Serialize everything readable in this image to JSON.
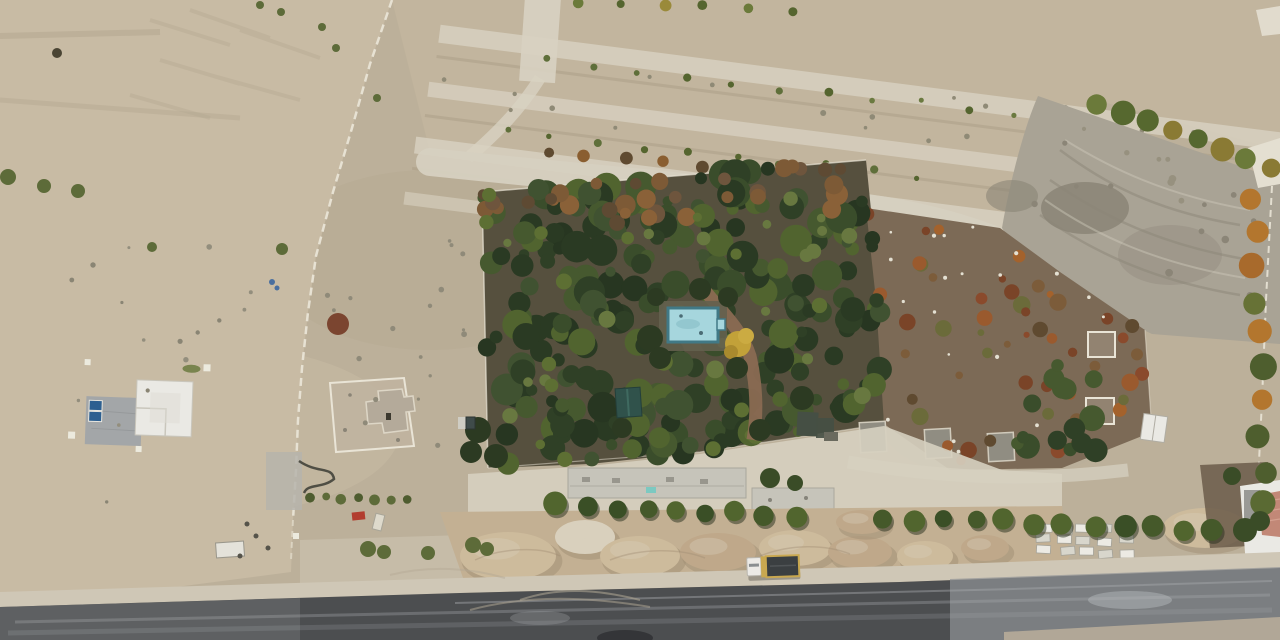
{
  "scene": {
    "kind": "aerial-drone-photograph",
    "subject": "arid construction site with walled orchard, swimming pool, terraced planting strips, sand piles, asphalt road and dump truck"
  },
  "palette": {
    "soil_base": "#bcb09a",
    "soil_left": "#c8bba4",
    "soil_strip": "#c2b59e",
    "ridge_pale": "#d8d2c2",
    "furrow": "#a89b83",
    "path_pale": "#d6d0c0",
    "excav": "#a9a395",
    "excav_dark": "#8b8577",
    "scar_light": "#cfc9ba",
    "white_path": "#e4dfd1",
    "wall_white": "#e9e4d6",
    "garden_floor": "#56503e",
    "field_brown": "#7c6a56",
    "pad_gray": "#908d82",
    "pad_stroke": "#d0cabb",
    "pad_concrete": "#c6c4ba",
    "pad_concrete_stroke": "#a8a69c",
    "cyan_mark": "#7cc9c1",
    "pool_blue": "#a6d6dd",
    "pool_border": "#417986",
    "pool_inner": "#8fc3cc",
    "pool_deck": "#64604e",
    "brick": "#8a6a52",
    "pavilion": "#30524b",
    "pavilion_stroke": "#243f3a",
    "struct_dark": "#454f44",
    "struct_gray": "#6a6a5e",
    "sand_base": "#c3b093",
    "sand_light": "#cdbb9c",
    "sand_mid": "#bfa88a",
    "sand_white": "#d9d0bd",
    "sand_shadow": "#9f8d73",
    "shoulder": "#cfc7b6",
    "asphalt": "#4c4e50",
    "asphalt_left": "#6f7173",
    "asphalt_right": "#909395",
    "streak": "#a6a9ab",
    "streak_bright": "#b9bcbe",
    "gravel": "#b4aa98",
    "truck_cab": "#eceae6",
    "truck_cab_stroke": "#b9b6ae",
    "truck_bed": "#3b3f41",
    "truck_rim": "#c9a850",
    "truck_glass": "#8a8e90",
    "house_white": "#eae9e4",
    "house_stroke": "#c9c6bc",
    "house_pad": "#a3a6a8",
    "pad_line": "#8e9193",
    "panel_blue": "#2d5f90",
    "panel_stroke": "#e8e6df",
    "post_white": "#eceade",
    "grass": "#6b7a3f",
    "encl_floor": "#c0b4a0",
    "bldg_tan": "#b4aa9a",
    "bldg_stroke": "#ddd6c6",
    "door_dark": "#3c392f",
    "yard_dark": "#6b5c4a",
    "roof_red": "#c28877",
    "roof_gray": "#9a9a96",
    "red_item": "#b23d2f",
    "teal_bin": "#3f4b4a",
    "bin_light": "#cfcdc4",
    "pave_gray": "#b6b4ac",
    "squiggle": "#43423a",
    "sign_white": "#dedacc",
    "trailer_white": "#e4e2da",
    "bush_green": "#5d6b39",
    "bush_red": "#7b4530",
    "bush_dark": "#4a4433",
    "tree_dark": "#3a4c27",
    "blue_debris": "#4a6f9f",
    "mottle_gray": "#b0a48d",
    "mottle_light": "#cfc3ac",
    "mottle_tan": "#b5ab9a",
    "rut": "#b2a68e",
    "pale_zone": "#cfc7b5",
    "tire_track": "#b3a995",
    "shed_stroke": "#b0ada3",
    "autumn_yellow": "#c2a139",
    "autumn_yellow2": "#cbab42",
    "autumn_olive": "#a98a2e",
    "canopy_over": "#2c3a22"
  },
  "render": [
    {
      "type": "scatter",
      "target": "g-leftlot-speckles",
      "name": "ground-speckle",
      "polygon": [
        [
          20,
          250
        ],
        [
          280,
          240
        ],
        [
          290,
          520
        ],
        [
          30,
          530
        ]
      ],
      "count": 16,
      "rmin": 1.5,
      "rmax": 3,
      "colors": [
        "#938e7d",
        "#8a8574"
      ],
      "seed": 27
    },
    {
      "type": "scatter",
      "target": "g-leftlot-speckles",
      "name": "ground-speckle",
      "polygon": [
        [
          310,
          240
        ],
        [
          470,
          230
        ],
        [
          470,
          470
        ],
        [
          305,
          470
        ]
      ],
      "count": 18,
      "rmin": 1.5,
      "rmax": 3,
      "colors": [
        "#8f8a79"
      ],
      "seed": 28
    },
    {
      "type": "scatter",
      "target": "g-terrace-shrubs",
      "name": "ground-speckle",
      "polygon": [
        [
          440,
          30
        ],
        [
          1200,
          120
        ],
        [
          1180,
          210
        ],
        [
          430,
          110
        ]
      ],
      "count": 26,
      "rmin": 1.5,
      "rmax": 3,
      "colors": [
        "#8f8a76"
      ],
      "seed": 30
    },
    {
      "type": "row",
      "target": "g-terrace-shrubs",
      "name": "shrub",
      "x0": 545,
      "y0": 62,
      "x1": 1060,
      "y1": 120,
      "n": 12,
      "rmin": 2.5,
      "rmax": 4.5,
      "jitter": 4,
      "colors": [
        "#5f6f3a",
        "#6b7a40",
        "#55652f"
      ],
      "seed": 3
    },
    {
      "type": "row",
      "target": "g-terrace-shrubs",
      "name": "shrub",
      "x0": 505,
      "y0": 131,
      "x1": 918,
      "y1": 178,
      "n": 10,
      "rmin": 2.5,
      "rmax": 4.5,
      "jitter": 4,
      "colors": [
        "#5f6f3a",
        "#55652f"
      ],
      "seed": 4
    },
    {
      "type": "row",
      "target": "g-terrace-shrubs",
      "name": "autumn-tree",
      "x0": 548,
      "y0": 151,
      "x1": 852,
      "y1": 186,
      "n": 9,
      "rmin": 4.5,
      "rmax": 7,
      "jitter": 3,
      "colors": [
        "#7a5a35",
        "#8a5e30",
        "#5f4a30",
        "#946a38"
      ],
      "seed": 5
    },
    {
      "type": "row",
      "target": "g-terrace-shrubs",
      "name": "shrub",
      "x0": 578,
      "y0": 6,
      "x1": 790,
      "y1": 9,
      "n": 6,
      "rmin": 4,
      "rmax": 6,
      "jitter": 3,
      "colors": [
        "#6b7a3a",
        "#9a8a3a",
        "#55652f"
      ],
      "seed": 6
    },
    {
      "type": "scatter",
      "target": "g-excav-speckles",
      "name": "dig-mark",
      "polygon": [
        [
          1050,
          110
        ],
        [
          1270,
          190
        ],
        [
          1270,
          330
        ],
        [
          1160,
          320
        ],
        [
          1010,
          230
        ]
      ],
      "count": 18,
      "rmin": 2,
      "rmax": 4,
      "colors": [
        "#8b8577",
        "#97917f"
      ],
      "seed": 29
    },
    {
      "type": "scatter",
      "target": "g-field-scatter",
      "name": "autumn-bush",
      "polygon": [
        [
          866,
          208
        ],
        [
          1000,
          228
        ],
        [
          1060,
          272
        ],
        [
          1145,
          330
        ],
        [
          1152,
          432
        ],
        [
          1062,
          468
        ],
        [
          950,
          470
        ],
        [
          884,
          424
        ],
        [
          876,
          300
        ]
      ],
      "count": 50,
      "rmin": 3,
      "rmax": 9,
      "colors": [
        "#8a4a2c",
        "#9a5a2e",
        "#7a4428",
        "#a4622c",
        "#5f4a30",
        "#6b6b3a",
        "#7c5c3a"
      ],
      "seed": 24
    },
    {
      "type": "scatter",
      "target": "g-field-scatter",
      "name": "litter-dot",
      "polygon": [
        [
          866,
          208
        ],
        [
          1000,
          228
        ],
        [
          1060,
          272
        ],
        [
          1145,
          330
        ],
        [
          1152,
          432
        ],
        [
          1062,
          468
        ],
        [
          950,
          470
        ],
        [
          884,
          424
        ],
        [
          876,
          300
        ]
      ],
      "count": 22,
      "rmin": 1.2,
      "rmax": 2.4,
      "colors": [
        "#e4e0d2"
      ],
      "seed": 25
    },
    {
      "type": "scatter",
      "target": "g-field-scatter",
      "name": "tree",
      "polygon": [
        [
          1020,
          360
        ],
        [
          1108,
          372
        ],
        [
          1112,
          468
        ],
        [
          1000,
          466
        ]
      ],
      "count": 16,
      "rmin": 6,
      "rmax": 13,
      "colors": [
        "#2f4026",
        "#3a4d2b",
        "#46592f"
      ],
      "seed": 26
    },
    {
      "type": "scatter",
      "target": "g-canopy",
      "name": "tree",
      "polygon": [
        [
          482,
          192
        ],
        [
          866,
          160
        ],
        [
          880,
          300
        ],
        [
          884,
          424
        ],
        [
          700,
          452
        ],
        [
          590,
          464
        ],
        [
          488,
          468
        ]
      ],
      "count": 250,
      "rmin": 5,
      "rmax": 16,
      "colors": [
        "#273621",
        "#2f4026",
        "#3a4d2b",
        "#46592f",
        "#51642f",
        "#2a3a23",
        "#405231"
      ],
      "seed": 21
    },
    {
      "type": "scatter",
      "target": "g-canopy",
      "name": "autumn-tree",
      "polygon": [
        [
          482,
          192
        ],
        [
          866,
          160
        ],
        [
          872,
          206
        ],
        [
          486,
          240
        ]
      ],
      "count": 34,
      "rmin": 5,
      "rmax": 11,
      "colors": [
        "#6e553d",
        "#7d5a36",
        "#8a6138",
        "#5e4a33"
      ],
      "seed": 22
    },
    {
      "type": "scatter",
      "target": "g-canopy",
      "name": "tree",
      "polygon": [
        [
          482,
          192
        ],
        [
          866,
          160
        ],
        [
          880,
          300
        ],
        [
          884,
          424
        ],
        [
          700,
          452
        ],
        [
          590,
          464
        ],
        [
          488,
          468
        ]
      ],
      "count": 40,
      "rmin": 4,
      "rmax": 9,
      "colors": [
        "#5d6f33",
        "#687840"
      ],
      "seed": 23
    },
    {
      "type": "circles",
      "target": "g-canopy-over",
      "name": "tree",
      "default": "#2c3a22",
      "items": [
        [
          700,
          289,
          11
        ],
        [
          656,
          297,
          9
        ],
        [
          728,
          297,
          10
        ],
        [
          650,
          338,
          13
        ],
        [
          737,
          368,
          11
        ],
        [
          660,
          358,
          11
        ],
        [
          478,
          430,
          13
        ],
        [
          471,
          452,
          11
        ],
        [
          496,
          456,
          12
        ],
        [
          760,
          430,
          11
        ],
        [
          802,
          398,
          12
        ],
        [
          622,
          428,
          10
        ]
      ]
    },
    {
      "type": "ellipses",
      "target": "g-piles",
      "name": "sand-pile",
      "shadow": "#9f8d73",
      "items": [
        [
          508,
          556,
          48,
          24,
          "sand_light"
        ],
        [
          585,
          537,
          30,
          17,
          "sand_white"
        ],
        [
          640,
          556,
          40,
          20,
          "sand_light"
        ],
        [
          718,
          552,
          38,
          19,
          "sand_mid"
        ],
        [
          795,
          548,
          36,
          18,
          "sand_light"
        ],
        [
          860,
          552,
          32,
          16,
          "sand_mid"
        ],
        [
          925,
          556,
          28,
          15,
          "sand_light"
        ],
        [
          985,
          548,
          24,
          13,
          "sand_mid"
        ],
        [
          1205,
          528,
          42,
          20,
          "sand_light"
        ],
        [
          862,
          522,
          26,
          12,
          "sand_mid"
        ]
      ]
    },
    {
      "type": "pallets",
      "target": "g-pallets",
      "name": "block-pallet",
      "x": 1038,
      "y": 524,
      "cols": 5,
      "rows": 3,
      "dx": 20,
      "dy": 12,
      "w": 14,
      "h": 8,
      "jitter": 3,
      "seed": 11,
      "fills": [
        "#eceae3",
        "#d8d6cc"
      ],
      "stroke": "#a5a399"
    },
    {
      "type": "row",
      "target": "g-tree-rows",
      "name": "tree",
      "x0": 558,
      "y0": 506,
      "x1": 1212,
      "y1": 529,
      "n": 23,
      "rmin": 8,
      "rmax": 12,
      "jitter": 3,
      "skip": [
        9,
        10
      ],
      "shadow": true,
      "colors": [
        "#3a4f26",
        "#45592a",
        "#51652e"
      ],
      "seed": 7
    },
    {
      "type": "row",
      "target": "g-tree-rows",
      "name": "tree",
      "x0": 1098,
      "y0": 104,
      "x1": 1272,
      "y1": 168,
      "n": 8,
      "rmin": 9,
      "rmax": 13,
      "jitter": 2,
      "colors": [
        "#56682f",
        "#617236",
        "#6b7a3a",
        "#8a7a34"
      ],
      "seed": 8
    },
    {
      "type": "row",
      "target": "g-tree-rows",
      "name": "tree",
      "x0": 1254,
      "y0": 195,
      "x1": 1263,
      "y1": 505,
      "n": 10,
      "rmin": 10,
      "rmax": 14,
      "jitter": 6,
      "colors": [
        "#4e5e2e",
        "#5a6a33",
        "#a86a2c",
        "#677236",
        "#b3762e"
      ],
      "seed": 9
    },
    {
      "type": "row",
      "target": "g-bushes",
      "name": "bush",
      "x0": 310,
      "y0": 496,
      "x1": 408,
      "y1": 500,
      "n": 7,
      "rmin": 3.5,
      "rmax": 5.5,
      "jitter": 2,
      "colors": [
        "#5d6b39",
        "#4e5c2f"
      ],
      "seed": 10
    },
    {
      "type": "circles",
      "target": "g-bushes",
      "name": "bush",
      "default": "#5d6b39",
      "items": [
        [
          8,
          177,
          8
        ],
        [
          44,
          186,
          7
        ],
        [
          78,
          191,
          7
        ],
        [
          152,
          247,
          5
        ],
        [
          282,
          249,
          6
        ],
        [
          260,
          5,
          4
        ],
        [
          281,
          12,
          4
        ],
        [
          322,
          27,
          4
        ],
        [
          336,
          48,
          4
        ],
        [
          377,
          98,
          4
        ],
        [
          338,
          324,
          11,
          "bush_red"
        ],
        [
          57,
          53,
          5,
          "bush_dark"
        ],
        [
          368,
          549,
          8
        ],
        [
          384,
          552,
          7
        ],
        [
          428,
          553,
          7
        ],
        [
          473,
          545,
          8
        ],
        [
          487,
          549,
          7
        ],
        [
          272,
          282,
          3,
          "blue_debris"
        ],
        [
          277,
          288,
          2.5,
          "blue_debris"
        ],
        [
          770,
          478,
          10,
          "tree_dark"
        ],
        [
          795,
          483,
          8,
          "tree_dark"
        ],
        [
          1245,
          530,
          12,
          "tree_dark"
        ],
        [
          1232,
          476,
          9,
          "tree_dark"
        ],
        [
          1260,
          521,
          10,
          "tree_dark"
        ]
      ]
    }
  ]
}
